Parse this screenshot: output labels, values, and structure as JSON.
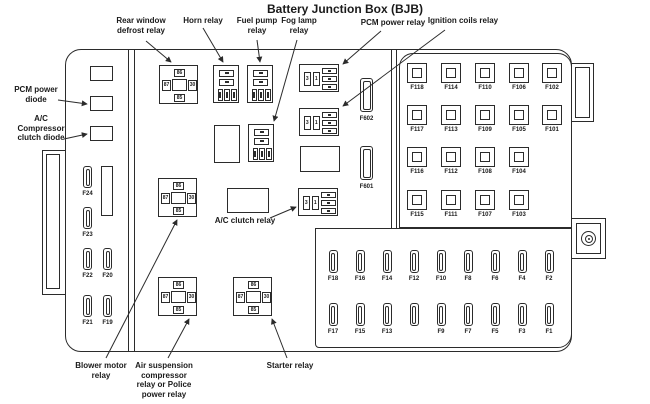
{
  "title": "Battery Junction Box (BJB)",
  "colors": {
    "line": "#2b2b2b",
    "background": "#ffffff"
  },
  "callouts": {
    "rear_window": "Rear window defrost relay",
    "horn": "Horn relay",
    "fuel_pump": "Fuel pump relay",
    "fog_lamp": "Fog lamp relay",
    "pcm_relay": "PCM power relay",
    "ignition": "Ignition coils relay",
    "pcm_diode": "PCM power diode",
    "ac_diode": "A/C Compressor clutch diode",
    "ac_clutch": "A/C clutch relay",
    "blower": "Blower motor relay",
    "air_suspension": "Air suspension compressor relay or Police power relay",
    "starter": "Starter relay"
  },
  "square_relay_pins": {
    "top": "86",
    "left": "87",
    "right": "30",
    "bottom": "85"
  },
  "pad_relay_pins": {
    "a": "3",
    "b": "1"
  },
  "left_fuses": [
    "F24",
    "F23",
    "F22",
    "F20",
    "F21",
    "F19"
  ],
  "mid_fuses": [
    "F602",
    "F601"
  ],
  "right_panel_rows": [
    [
      "F118",
      "F114",
      "F110",
      "F106",
      "F102"
    ],
    [
      "F117",
      "F113",
      "F109",
      "F105",
      "F101"
    ],
    [
      "F116",
      "F112",
      "F108",
      "F104"
    ],
    [
      "F115",
      "F111",
      "F107",
      "F103"
    ]
  ],
  "bottom_panel_rows": [
    [
      "F18",
      "F16",
      "F14",
      "F12",
      "F10",
      "F8",
      "F6",
      "F4",
      "F2"
    ],
    [
      "F17",
      "F15",
      "F13",
      "",
      "F9",
      "F7",
      "F5",
      "F3",
      "F1"
    ]
  ]
}
